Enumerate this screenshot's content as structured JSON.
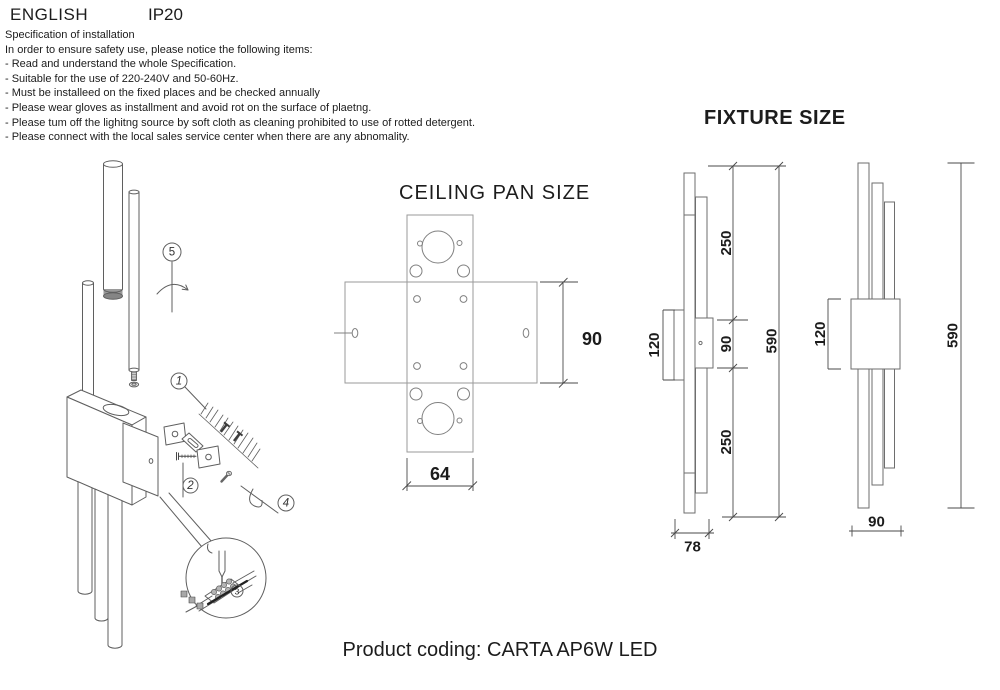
{
  "header": {
    "language": "ENGLISH",
    "ip_rating": "IP20"
  },
  "spec": {
    "title": "Specification of installation",
    "intro": "In order to ensure safety use, please notice the following items:",
    "items": [
      "- Read and understand the whole Specification.",
      "- Suitable for the use of 220-240V and 50-60Hz.",
      "- Must be installeed on the fixed places and be checked annually",
      "- Please wear gloves as installment and avoid rot on the surface of plaetng.",
      "- Please tum off the lighitng source by soft cloth as cleaning prohibited to use of rotted detergent.",
      "- Please connect with the local sales service center when there are any abnomality."
    ]
  },
  "installation_steps": {
    "step1": "1",
    "step2": "2",
    "step3": "3",
    "step4": "4",
    "step5": "5"
  },
  "ceiling_pan": {
    "title": "CEILING PAN SIZE",
    "pan_width": "64",
    "pan_height": "90"
  },
  "fixture": {
    "title": "FIXTURE SIZE",
    "side_view": {
      "body_height": "120",
      "upper_tube": "250",
      "body": "90",
      "overall_height": "590",
      "lower_tube": "250",
      "depth": "78"
    },
    "front_view": {
      "body_height": "120",
      "overall_height": "590",
      "width": "90"
    }
  },
  "footer": {
    "product_coding": "Product coding: CARTA AP6W LED"
  }
}
